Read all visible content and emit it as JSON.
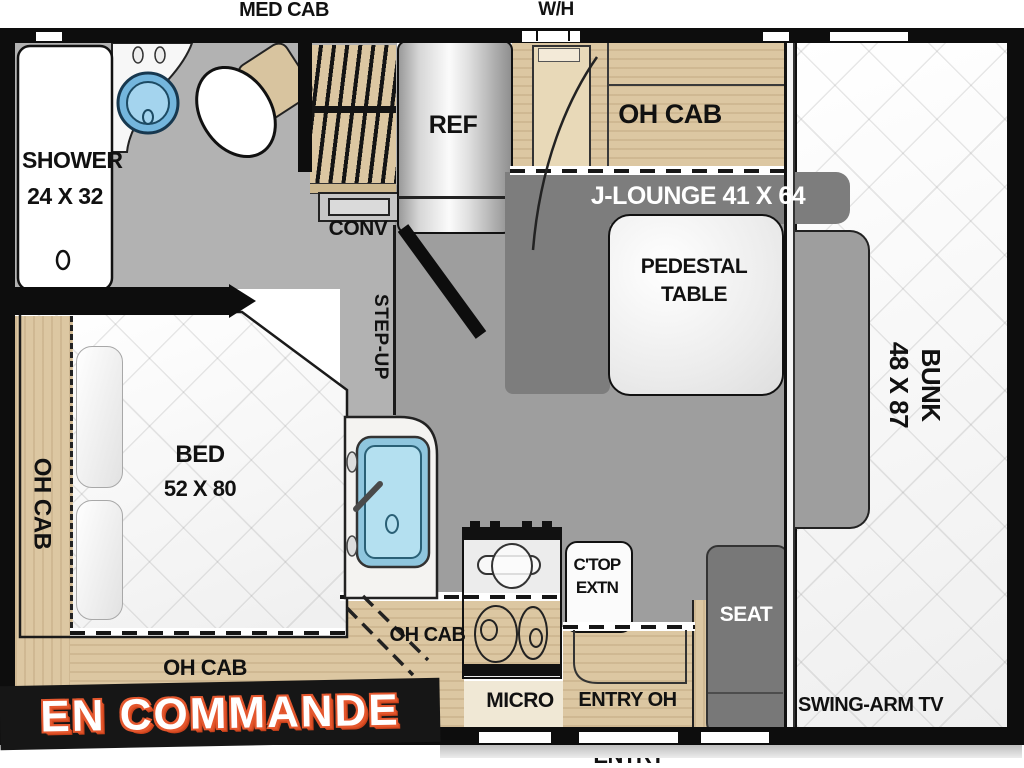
{
  "exterior": {
    "med_cab": "MED CAB",
    "water_heater": "W/H",
    "entry": "ENTRY"
  },
  "bathroom": {
    "shower_line1": "SHOWER",
    "shower_line2": "24 X 32"
  },
  "kitchen": {
    "ref": "REF",
    "conv": "CONV",
    "step_up": "STEP-UP",
    "micro": "MICRO",
    "ctop_line1": "C'TOP",
    "ctop_line2": "EXTN",
    "oh_cab": "OH CAB",
    "entry_oh": "ENTRY OH"
  },
  "dinette": {
    "oh_cab": "OH CAB",
    "j_lounge": "J-LOUNGE 41 X 64",
    "pedestal_line1": "PEDESTAL",
    "pedestal_line2": "TABLE",
    "seat": "SEAT"
  },
  "bedroom": {
    "bed_line1": "BED",
    "bed_line2": "52 X 80",
    "oh_cab_left": "OH CAB",
    "oh_cab_foot": "OH CAB"
  },
  "bunk_room": {
    "bunk_line1": "BUNK",
    "bunk_line2": "48 X 87",
    "swing_arm_tv": "SWING-ARM TV"
  },
  "banner": {
    "text": "EN COMMANDE"
  },
  "colors": {
    "wall": "#0d0d0d",
    "floor": "#b2b2b2",
    "floor_main": "#9e9e9e",
    "bench_gray": "#7d7d7d",
    "wood": "#dcc7a2",
    "sink_blue": "#a8d8ea",
    "banner_bg": "#161616",
    "banner_outline": "#e4572e"
  }
}
